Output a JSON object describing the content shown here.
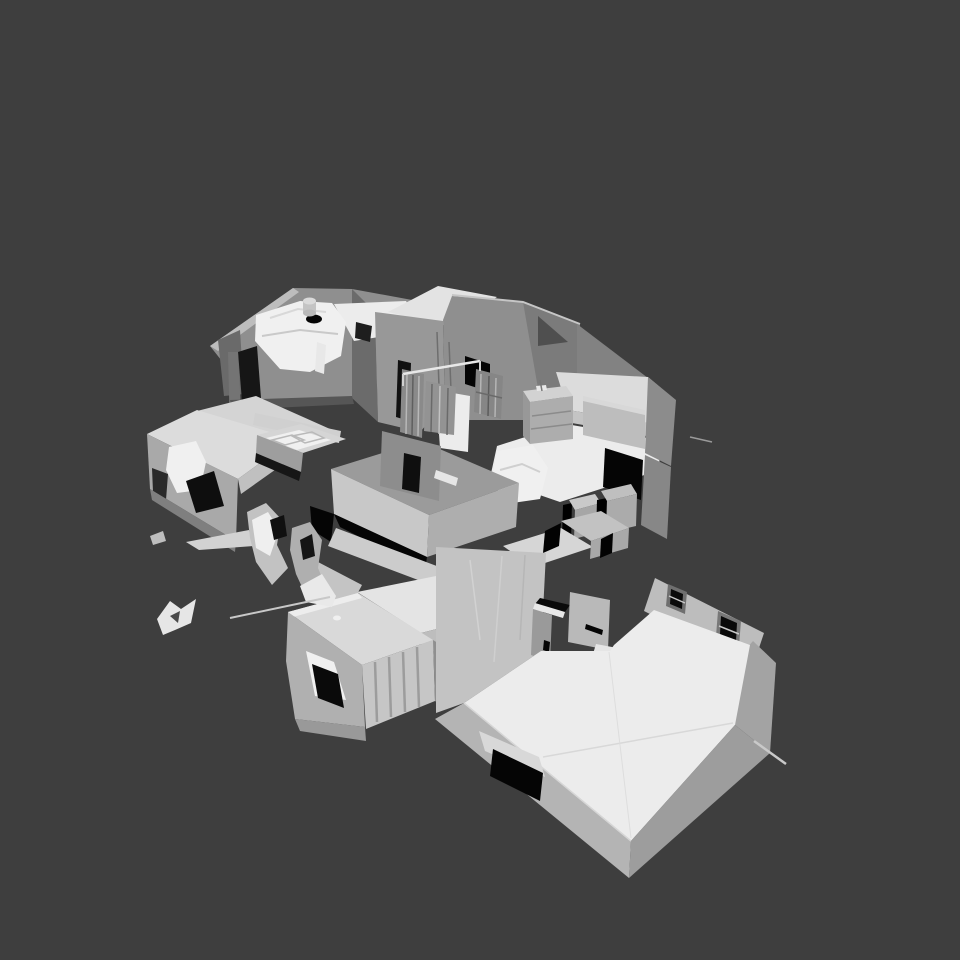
{
  "scene": {
    "description": "Untextured grayscale 3D mesh of a scanned multi-room apartment, viewed from a high three-quarter angle, floating on a plain dark gray background. No UI chrome, toolbars or text are visible.",
    "background_color": "#3E3E3E",
    "mesh_regions": [
      "upper-left-bedroom",
      "upper-hallway-walls",
      "stair-railings",
      "right-bedroom",
      "left-roofed-block",
      "kitchen-counters",
      "center-cabinets",
      "lower-left-closed-rooms",
      "great-room",
      "mesh-debris"
    ]
  },
  "palette": {
    "bg": "#3E3E3E",
    "floor": "#ECECEC",
    "white": "#F0F0F0",
    "slab": "#DCDCDC",
    "slab2": "#CFCFCF",
    "wall_light": "#BDBDBD",
    "wall_mid": "#A3A3A3",
    "wall": "#8F8F8F",
    "wall_dark": "#7A7A7A",
    "shadow": "#161616",
    "black": "#050505"
  }
}
